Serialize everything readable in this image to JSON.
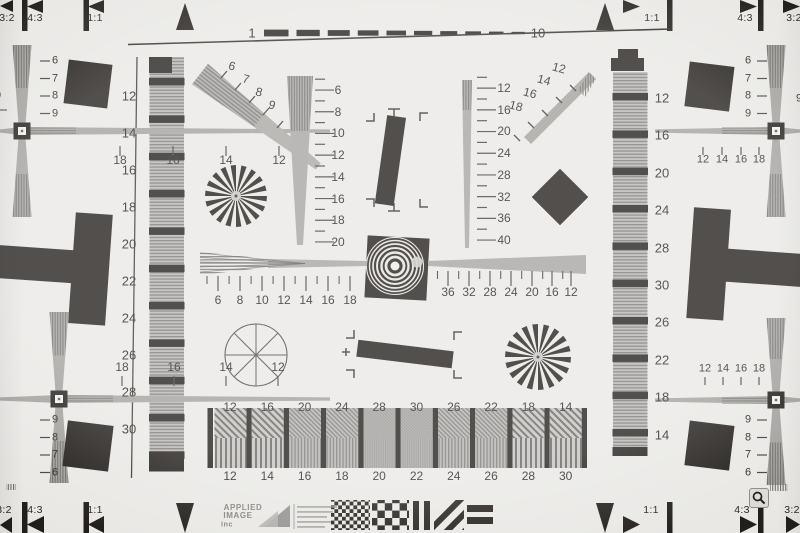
{
  "colors": {
    "paper": "#e9e8e5",
    "ink": "#221e1b",
    "gray": "#a2a09d"
  },
  "strips": {
    "top": {
      "left": [
        "3:2",
        "4:3",
        "1:1"
      ],
      "right": [
        "1:1",
        "4:3",
        "3:2"
      ],
      "scale_start": "1",
      "scale_end": "10",
      "dash_count": 10
    },
    "bottom": {
      "left": [
        "3:2",
        "4:3",
        "1:1"
      ],
      "right": [
        "1:1",
        "4:3",
        "3:2"
      ]
    }
  },
  "logo": {
    "line1": "APPLIED",
    "line2": "IMAGE",
    "line3": "Inc"
  },
  "scales": {
    "left_frame": [
      "12",
      "14",
      "16",
      "18",
      "20",
      "22",
      "24",
      "26",
      "28",
      "30"
    ],
    "right_frame": [
      "12",
      "16",
      "20",
      "24",
      "28",
      "30",
      "26",
      "22",
      "18",
      "14"
    ],
    "center_vertical": [
      "6",
      "8",
      "10",
      "12",
      "14",
      "16",
      "18",
      "20"
    ],
    "mid_right_vertical": [
      "12",
      "16",
      "20",
      "24",
      "28",
      "32",
      "36",
      "40"
    ],
    "sweep_left": [
      "6",
      "8",
      "10",
      "12",
      "14",
      "16",
      "18"
    ],
    "sweep_right": [
      "36",
      "32",
      "28",
      "24",
      "20",
      "16",
      "12"
    ],
    "bars_top": [
      "12",
      "16",
      "20",
      "24",
      "28",
      "30",
      "26",
      "22",
      "18",
      "14"
    ],
    "bars_bottom": [
      "12",
      "14",
      "16",
      "18",
      "20",
      "22",
      "24",
      "26",
      "28",
      "30"
    ],
    "diag_upper_left": [
      "6",
      "7",
      "8",
      "9"
    ],
    "diag_upper_right": [
      "12",
      "14",
      "16",
      "18"
    ],
    "cross_top_left_h": [
      "18",
      "16",
      "14",
      "12"
    ],
    "cross_top_left_v": [
      "6",
      "7",
      "8",
      "9"
    ],
    "cross_bottom_left_h": [
      "18",
      "16",
      "14",
      "12"
    ],
    "cross_bottom_left_v": [
      "9",
      "8",
      "7",
      "6"
    ],
    "cross_top_right_h": [
      "12",
      "14",
      "16",
      "18"
    ],
    "cross_top_right_v": [
      "6",
      "7",
      "8",
      "9"
    ],
    "cross_bottom_right_h": [
      "12",
      "14",
      "16",
      "18"
    ],
    "cross_bottom_right_v": [
      "9",
      "8",
      "7",
      "6"
    ],
    "edge_clipped_left": "9",
    "edge_clipped_right": "9"
  }
}
